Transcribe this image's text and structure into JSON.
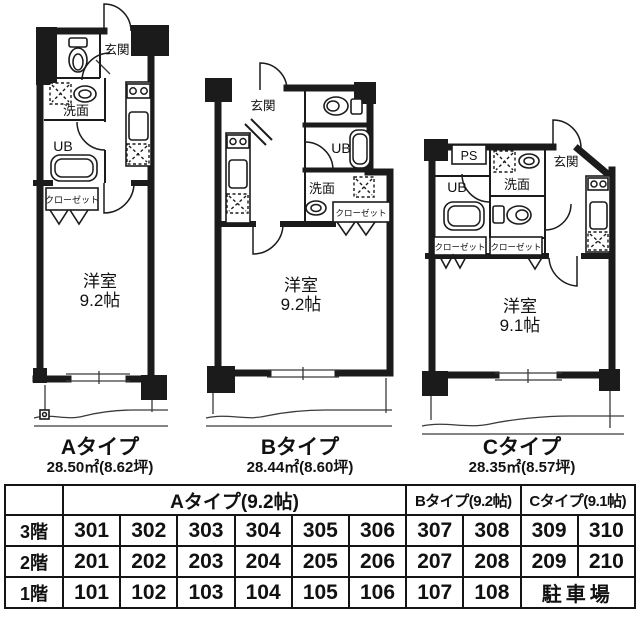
{
  "colors": {
    "ink": "#1b1b1b",
    "paper": "#ffffff"
  },
  "plans": [
    {
      "name": "Aタイプ",
      "area": "28.50㎡(8.62坪)",
      "room": "洋室",
      "size": "9.2帖",
      "entrance": "玄関",
      "washroom": "洗面",
      "bath": "UB",
      "closet": "クローゼット"
    },
    {
      "name": "Bタイプ",
      "area": "28.44㎡(8.60坪)",
      "room": "洋室",
      "size": "9.2帖",
      "entrance": "玄関",
      "washroom": "洗面",
      "bath": "UB",
      "closet": "クローゼット"
    },
    {
      "name": "Cタイプ",
      "area": "28.35㎡(8.57坪)",
      "room": "洋室",
      "size": "9.1帖",
      "entrance": "玄関",
      "washroom": "洗面",
      "bath": "UB",
      "closet1": "クローゼット",
      "closet2": "クローゼット",
      "ps": "PS"
    }
  ],
  "table": {
    "headers": {
      "a": "Aタイプ(9.2帖)",
      "b": "Bタイプ(9.2帖)",
      "c": "Cタイプ(9.1帖)"
    },
    "rows": [
      {
        "floor": "3階",
        "cells": [
          "301",
          "302",
          "303",
          "304",
          "305",
          "306",
          "307",
          "308",
          "309",
          "310"
        ]
      },
      {
        "floor": "2階",
        "cells": [
          "201",
          "202",
          "203",
          "204",
          "205",
          "206",
          "207",
          "208",
          "209",
          "210"
        ]
      },
      {
        "floor": "1階",
        "cells": [
          "101",
          "102",
          "103",
          "104",
          "105",
          "106",
          "107",
          "108"
        ],
        "parking": "駐車場"
      }
    ]
  }
}
